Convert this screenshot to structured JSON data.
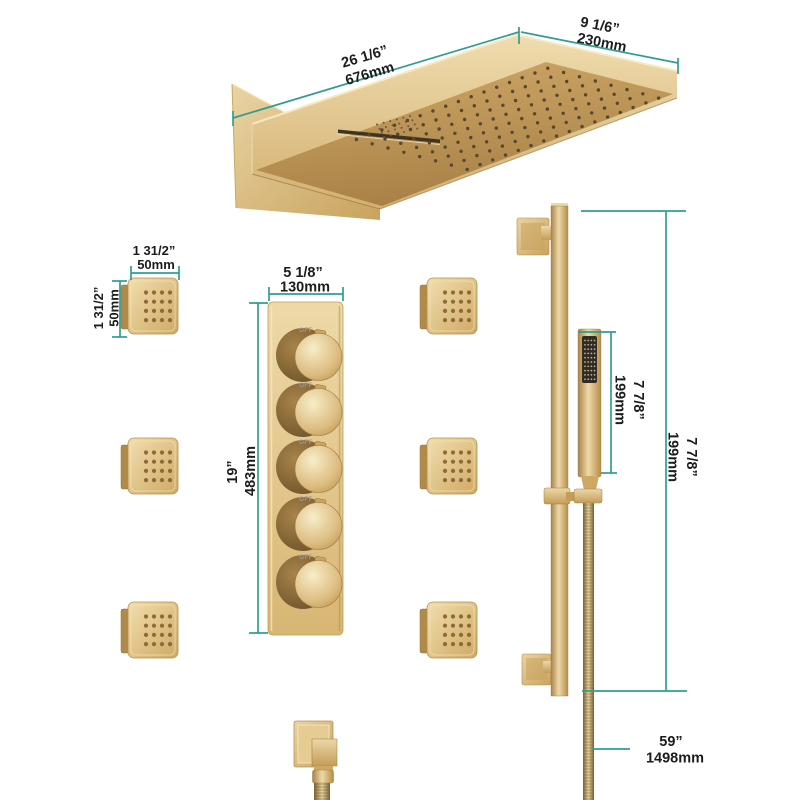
{
  "page": {
    "background": "#ffffff"
  },
  "style": {
    "accent_teal": "#2f9e90",
    "gold_light": "#eed9a8",
    "gold_mid": "#d3b070",
    "gold_dark": "#9a7a40",
    "text_color": "#1c1c1c"
  },
  "annotations": {
    "head_length": {
      "inches": "26 1/6”",
      "mm": "676mm"
    },
    "head_width": {
      "inches": "9 1/6”",
      "mm": "230mm"
    },
    "body_jet_width": {
      "inches": "1 31/2”",
      "mm": "50mm"
    },
    "body_jet_height": {
      "inches": "1 31/2”",
      "mm": "50mm"
    },
    "valve_width": {
      "inches": "5 1/8”",
      "mm": "130mm"
    },
    "valve_height": {
      "inches": "19”",
      "mm": "483mm"
    },
    "hand_shower_length": {
      "inches": "7 7/8”",
      "mm": "199mm"
    },
    "slide_bar_length": {
      "inches": "7 7/8”",
      "mm": "199mm"
    },
    "hose_length": {
      "inches": "59”",
      "mm": "1498mm"
    }
  },
  "valve": {
    "knob_count": 5,
    "knob_off_label": "OFF"
  },
  "body_jets": {
    "count": 6
  }
}
